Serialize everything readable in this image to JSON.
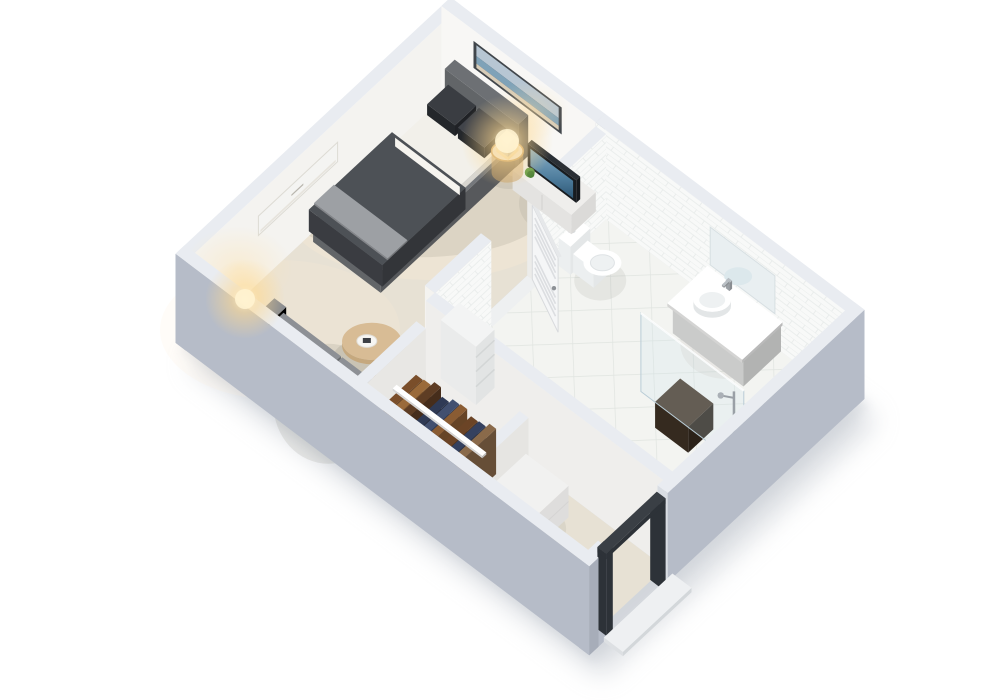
{
  "scene": {
    "name": "studio-apartment-3d-floorplan",
    "description": "Isometric 3D cutaway render of a studio apartment with bedroom-living area, bathroom, closet and entry",
    "background": "#ffffff",
    "view": "isometric-birdseye"
  },
  "palette": {
    "wall_interior": "#f4f3f0",
    "wall_interior_bright": "#f8f7f5",
    "wall_top": "#e9ecf1",
    "wall_exterior": "#b6bcc8",
    "wall_exterior_dark": "#a7adb9",
    "carpet": "#e7e1d4",
    "bath_floor": "#f3f4f1",
    "bath_grout": "#e0e4e0",
    "tile_wall": "#f8f9f8",
    "tile_line": "#e7ebea",
    "glass": "#cfe2ea",
    "shadow": "#b9bfc7"
  },
  "rooms": [
    {
      "name": "bedroom-living"
    },
    {
      "name": "bathroom"
    },
    {
      "name": "closet"
    },
    {
      "name": "entry"
    }
  ],
  "furniture": {
    "bed": {
      "base": "#75787c",
      "headboard": "#6d7074",
      "duvet": "#45484d",
      "runner": "#9da0a4",
      "pillow": "#2b2e33",
      "sheet": "#f2f0ea"
    },
    "sofa": {
      "body": "#84878c",
      "cushion": "#8d9095",
      "pillow": "#f3f2f0"
    },
    "coffee_table": {
      "oak": "#d8bc95",
      "tray": "#f6f5f2",
      "item": "#3c3f44"
    },
    "side_table": {
      "wood": "#d2ac7c",
      "lamp": "#fdf3dd"
    },
    "nightstand": {
      "brass": "#c9a36a",
      "glassTop": "#e8e4da",
      "lamp": "#ffeccb"
    },
    "tv_console": {
      "body": "#efeeec"
    },
    "tv": {
      "frame": "#1c2126",
      "screen": "#4e7d9d",
      "screen_hi": "#87aec7"
    },
    "plants": {
      "foliage": "#5d9a43",
      "foliage_dark": "#477f33",
      "pot": "#e8e4da"
    },
    "wall_art": {
      "frame": "#41464b",
      "sky": "#b7c6d3",
      "sea": "#7fa2b8",
      "sand": "#d7ccb8"
    },
    "ac_unit": {
      "body": "#f4f4f2",
      "vent": "#b9b6ae"
    },
    "toilet": {
      "body": "#ffffff",
      "shade": "#e4e7e8"
    },
    "vanity": {
      "cabinet": "#f1f2f1",
      "counter": "#fcfcfb",
      "sink": "#ffffff"
    },
    "mirror": {
      "glass": "#e9eff1"
    },
    "shower": {
      "hardware": "#9aa0a6",
      "bench": "#47382a",
      "bench_dark": "#352a1f"
    },
    "bathroom_door": {
      "leaf": "#f5f6f7",
      "edge": "#d8dadd",
      "louver": "#dcdee1"
    },
    "shelf_unit": {
      "body": "#f3f4f4"
    },
    "closet": {
      "rail": "#ffffff",
      "dresser": "#f1f1f0",
      "clothes": [
        "#7a4e2a",
        "#9a6a3a",
        "#5e3d24",
        "#2f3a55",
        "#425070",
        "#8a5c33",
        "#6b4426",
        "#35415f",
        "#8a6a4a"
      ]
    },
    "entry": {
      "frame": "#3a3f45",
      "frame_dark": "#2d3238",
      "threshold": "#eef0f2"
    }
  },
  "lighting": {
    "lamp_glow": "#ffd98f",
    "lamp_core": "#fff3d0",
    "wall_wash": "#ffe1a8"
  }
}
